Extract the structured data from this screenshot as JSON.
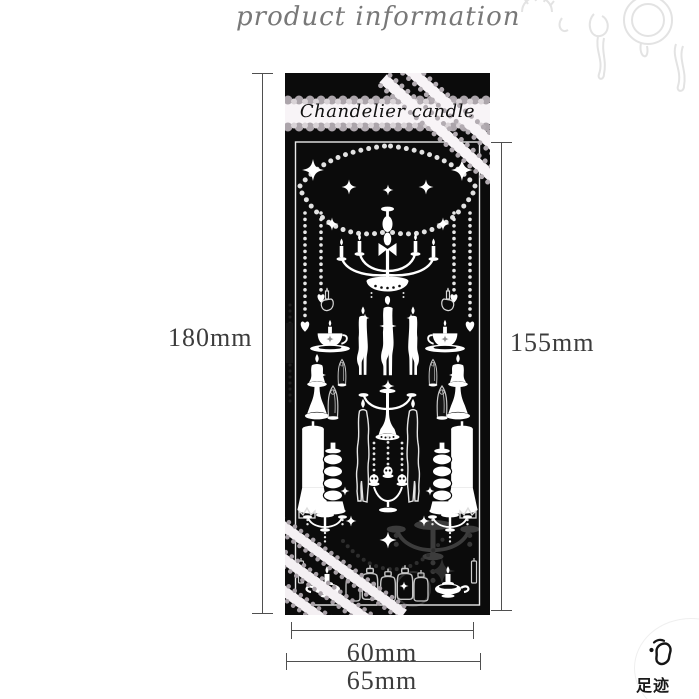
{
  "header": {
    "title": "product information"
  },
  "product": {
    "label": "Chandelier candle"
  },
  "dimensions": {
    "outer_height": "180mm",
    "inner_height": "155mm",
    "inner_width": "60mm",
    "outer_width": "65mm"
  },
  "badge": {
    "label": "足迹",
    "icon": "footprint-icon"
  },
  "colors": {
    "sheet_black": "#0b0b0b",
    "art_white": "#ffffff",
    "lace_gray": "#b3acb2",
    "band_bg": "#f8f4f7",
    "dimension_line": "#4f4f4f",
    "dimension_text": "#3c3c3c",
    "doodle_gray": "#e3e3e3"
  }
}
